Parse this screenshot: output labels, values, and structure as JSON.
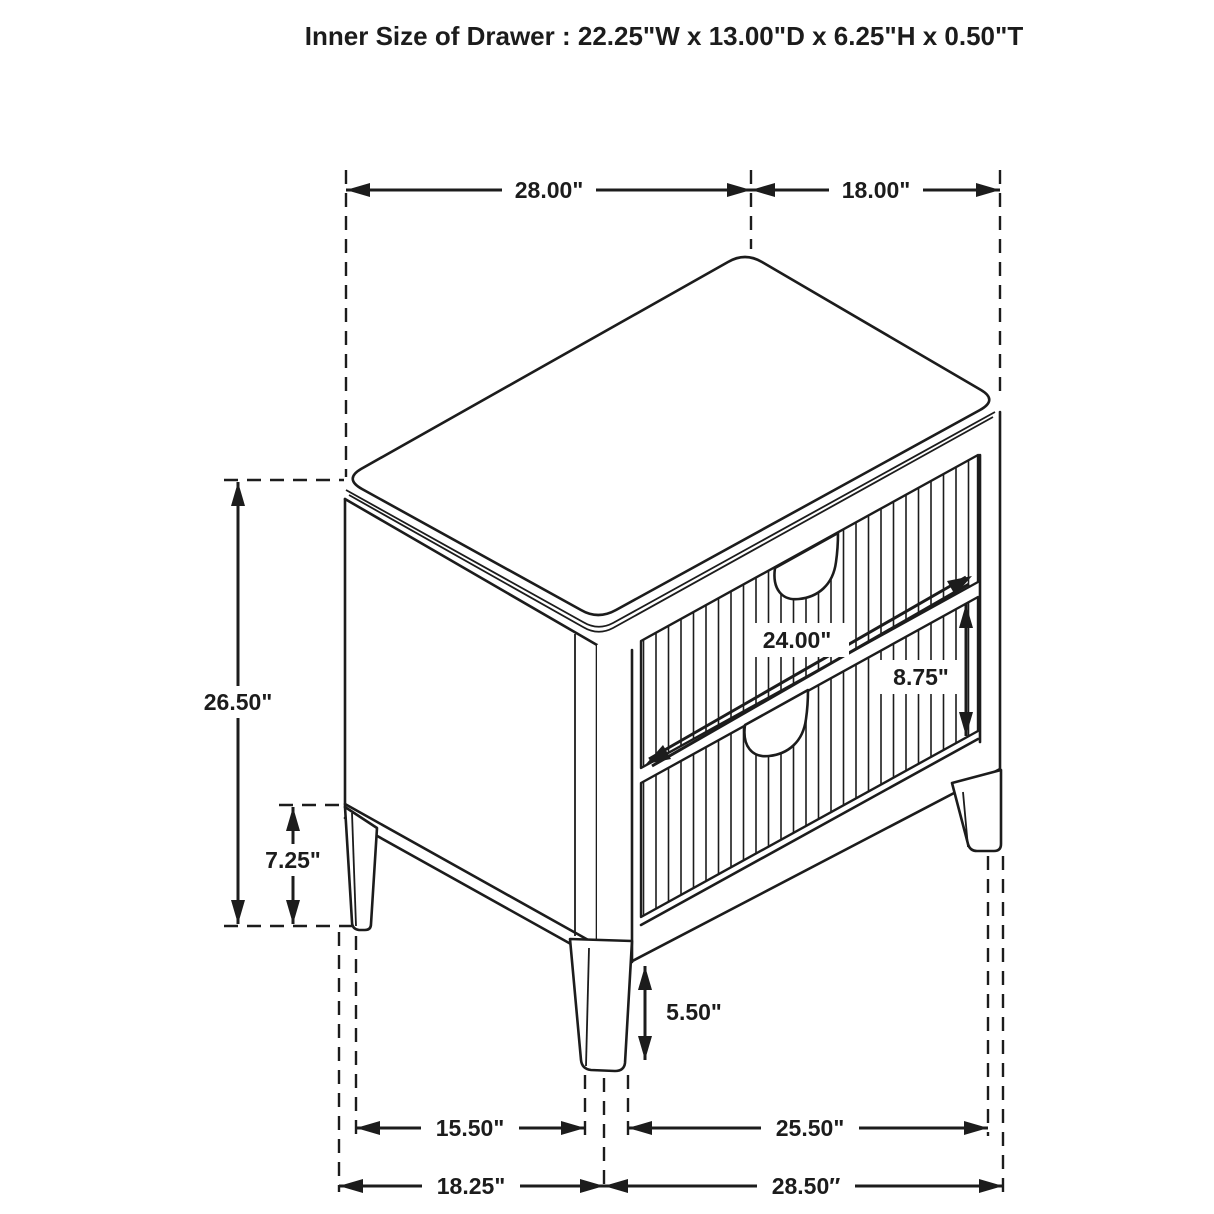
{
  "title": "Inner Size of Drawer : 22.25\"W x 13.00\"D x 6.25\"H x 0.50\"T",
  "dimensions": {
    "top_width": "28.00\"",
    "top_depth": "18.00\"",
    "overall_height": "26.50\"",
    "leg_height_side": "7.25\"",
    "drawer_front_width": "24.00\"",
    "drawer_front_height": "8.75\"",
    "leg_height_front": "5.50\"",
    "base_depth_inner": "15.50\"",
    "base_width_inner": "25.50\"",
    "base_depth_overall": "18.25\"",
    "base_width_overall": "28.50″"
  },
  "colors": {
    "line": "#1c1c1c",
    "background": "#ffffff"
  }
}
